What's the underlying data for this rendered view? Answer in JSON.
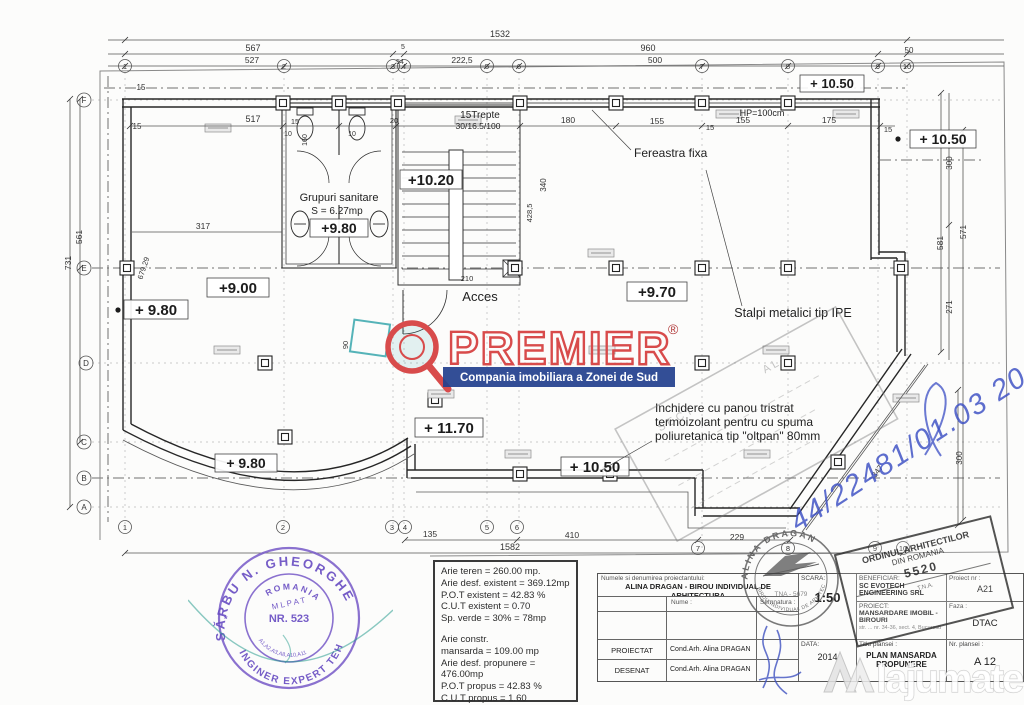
{
  "watermark": {
    "brand": "PREMIER",
    "registered": "®",
    "tagline": "Compania imobiliara a Zonei de Sud",
    "brand_color": "#d84b4b",
    "tagline_bg": "#23418e"
  },
  "site_watermark": {
    "name": "lajumate",
    "tld": ".ro",
    "accent": "#ff7a1a"
  },
  "plan": {
    "grid_top": [
      "1",
      "2",
      "3",
      "4",
      "5",
      "6",
      "7",
      "8",
      "9",
      "10"
    ],
    "grid_bottom": [
      "1",
      "2",
      "3",
      "4",
      "5",
      "6",
      "7",
      "8",
      "9",
      "10"
    ],
    "grid_left": [
      "F",
      "E",
      "D",
      "C",
      "B",
      "A"
    ],
    "dims": {
      "t1532": "1532",
      "t567": "567",
      "t5": "5",
      "t960": "960",
      "t50": "50",
      "t527": "527",
      "t54": "54",
      "t2225": "222,5",
      "t500": "500",
      "i15a": "15",
      "i517": "517",
      "i15b": "15",
      "i15c": "15",
      "i10a": "10",
      "i160": "160",
      "i10b": "10",
      "i20": "20",
      "i180": "180",
      "i155a": "155",
      "i15d": "15",
      "i155b": "155",
      "i175": "175",
      "i15e": "15",
      "l731": "731",
      "l561": "561",
      "l317": "317",
      "l679": "679,29",
      "s4285": "428,5",
      "s340": "340",
      "s90": "90",
      "s210": "210",
      "r571": "571",
      "r581": "581",
      "r300a": "300",
      "r271": "271",
      "r347": "347",
      "r300b": "300",
      "b135": "135",
      "b410": "410",
      "b229": "229",
      "b1582": "1582"
    },
    "levels": {
      "lv1050a": "+ 10.50",
      "lv1050b": "+ 10.50",
      "lv1020": "+10.20",
      "lv980a": "+9.80",
      "lv900": "+9.00",
      "lv980b": "+ 9.80",
      "lv970": "+9.70",
      "lv1170": "+ 11.70",
      "lv980c": "+ 9.80",
      "lv1050c": "+ 10.50"
    },
    "labels": {
      "stairs1": "15Trepte",
      "stairs2": "30/16.5/100",
      "window": "Fereastra fixa",
      "hp": "HP=100cm",
      "sanitary1": "Grupuri sanitare",
      "sanitary2": "S = 6.27mp",
      "access": "Acces",
      "columns": "Stalpi metalici tip IPE",
      "note1": "Inchidere cu panou tristrat",
      "note2": "termoizolant pentru cu spuma",
      "note3": "poliuretanica tip \"oltpan\" 80mm"
    },
    "faint_stamp": {
      "a": "SECT",
      "b": "AL"
    },
    "handwriting": "44/22481/01.03 2014"
  },
  "areas": {
    "lines_top": [
      "Arie teren = 260.00 mp.",
      "Arie desf. existent = 369.12mp",
      "P.O.T existent = 42.83 %",
      "C.U.T existent = 0.70",
      "Sp. verde = 30% = 78mp"
    ],
    "lines_bottom": [
      "Arie constr.",
      "mansarda = 109.00 mp",
      "Arie desf. propunere = 476.00mp",
      "P.O.T propus = 42.83 %",
      "C.U.T propus = 1.60"
    ]
  },
  "stamp_engineer": {
    "arc_top": "SĂRBU N. GHEORGHE",
    "line1": "ROMANIA",
    "line2": "M L P A T",
    "line3": "NR. 523",
    "line4": "A1,A2,A3,A8,A10,A11",
    "arc_bottom": "INGINER EXPERT TEHNIC"
  },
  "stamp_architect": {
    "arc_top": "ALINA DRAGAN",
    "center": "TNA - 5679",
    "arc_bottom": "BIROU INDIVIDUAL DE ARHITECTURA"
  },
  "stamp_order": {
    "line1": "ORDINUL ARHITECTILOR",
    "line2": "DIN ROMANIA",
    "line3": "5520",
    "line4": "T.N.A."
  },
  "titleblock": {
    "header_small": "Numele si denumirea proiectantului:",
    "firm": "ALINA DRAGAN - BIROU INDIVIDUAL DE ARHITECTURA",
    "col_nume": "Nume :",
    "col_sem": "Semnatura :",
    "row1_role": "PROIECTAT",
    "row1_name": "Cond.Arh. Alina DRAGAN",
    "row2_role": "DESENAT",
    "row2_name": "Cond.Arh. Alina DRAGAN",
    "scara_label": "SCARA:",
    "scara_value": "1:50",
    "data_label": "DATA:",
    "data_value": "2014",
    "beneficiar_label": "BENEFICIAR:",
    "beneficiar": "SC EVOTECH ENGINEERING SRL",
    "proiect_label": "PROIECT:",
    "proiect": "MANSARDARE IMOBIL - BIROURI",
    "proiect_addr": "str. ... nr. 34-36, sect. 4, Bucuresti",
    "faza_label": "Faza :",
    "faza": "DTAC",
    "proiect_nr_label": "Proiect nr :",
    "proiect_nr": "A21",
    "titlu_label": "Titlu plansei :",
    "titlu1": "PLAN MANSARDA",
    "titlu2": "PROPUNERE",
    "nr_label": "Nr. plansei :",
    "nr": "A 12"
  }
}
